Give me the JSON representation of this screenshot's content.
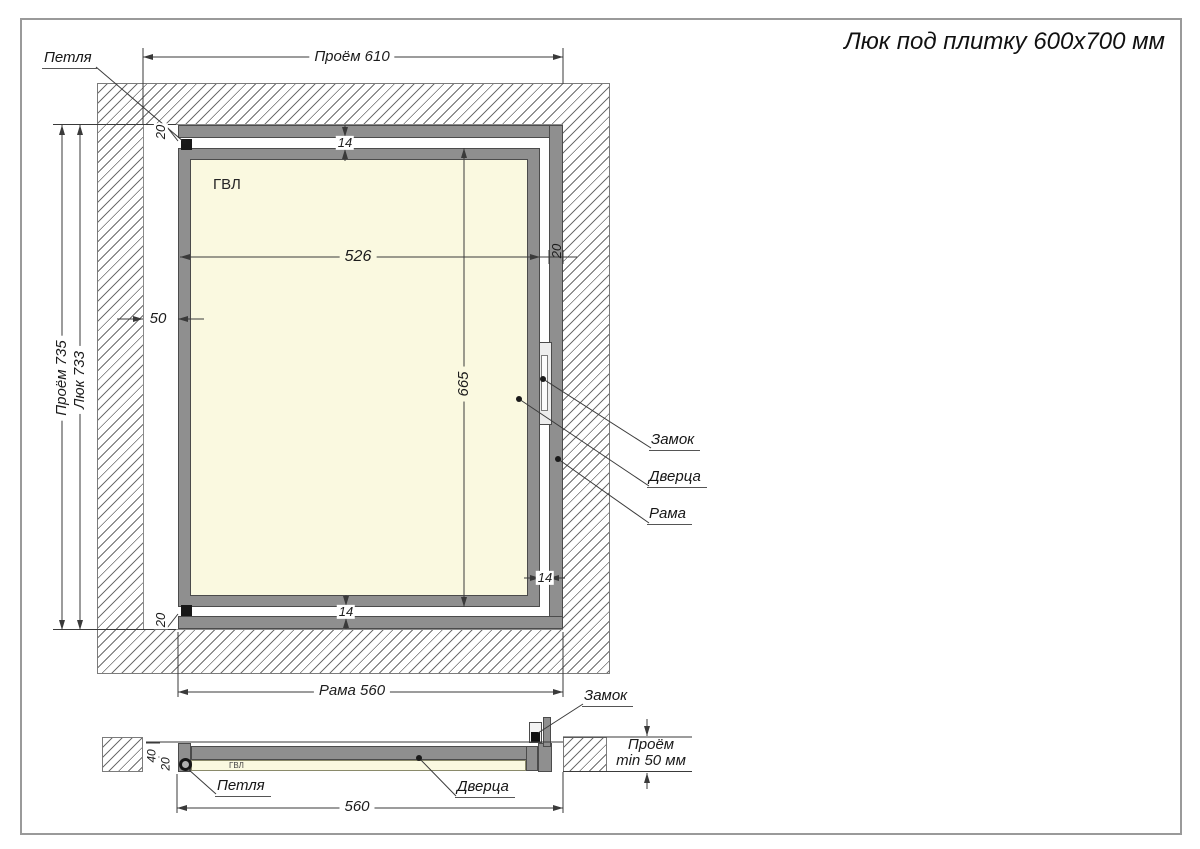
{
  "title": "Люк под плитку 600x700 мм",
  "main_view": {
    "panel_label": "ГВЛ",
    "callouts": {
      "hinge": "Петля",
      "lock": "Замок",
      "door": "Дверца",
      "frame": "Рама"
    },
    "dimensions": {
      "opening_width": "Проём 610",
      "opening_height": "Проём 735",
      "hatch_height": "Люк 733",
      "side_gap": "50",
      "door_width": "526",
      "door_height": "665",
      "top_offset": "20",
      "bottom_offset": "20",
      "frame_profile_width": "20",
      "top_gap": "14",
      "bottom_gap": "14",
      "right_gap": "14",
      "frame_width": "Рама 560"
    }
  },
  "section_view": {
    "panel_label": "ГВЛ",
    "callouts": {
      "lock": "Замок",
      "hinge": "Петля",
      "door": "Дверца"
    },
    "dimensions": {
      "total_depth": "40",
      "door_depth": "20",
      "frame_width": "560",
      "opening_depth_line1": "Проём",
      "opening_depth_line2": "min 50 мм"
    }
  },
  "colors": {
    "steel_gray": "#8f8f8f",
    "panel_cream": "#faf9e0",
    "line": "#3a3a3a"
  }
}
